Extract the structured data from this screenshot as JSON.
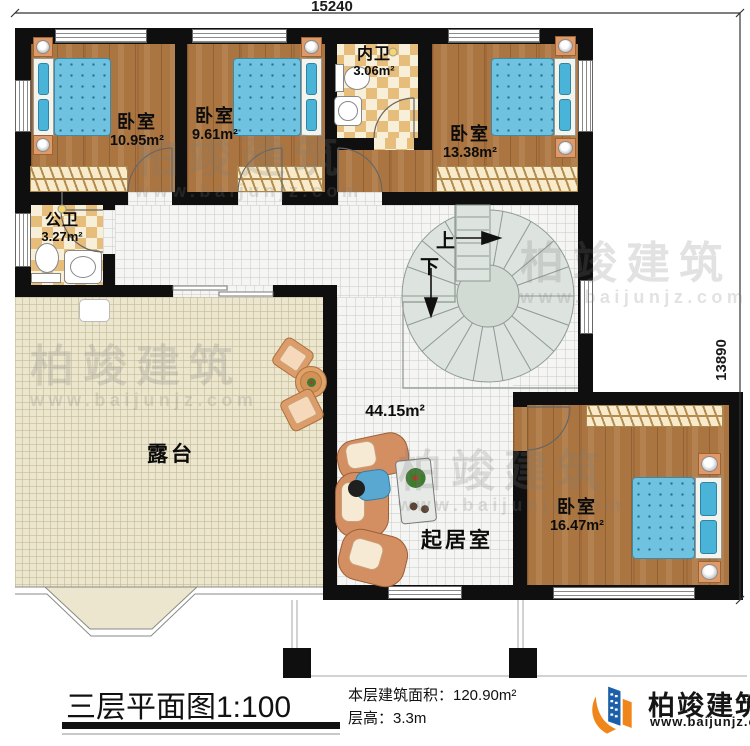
{
  "dimensions": {
    "width": "15240",
    "height": "13890"
  },
  "rooms": {
    "bedroom_tl": {
      "name": "卧室",
      "area": "10.95m²"
    },
    "bedroom_tm": {
      "name": "卧室",
      "area": "9.61m²"
    },
    "bedroom_tr": {
      "name": "卧室",
      "area": "13.38m²"
    },
    "bedroom_br": {
      "name": "卧室",
      "area": "16.47m²"
    },
    "bath_inner": {
      "name": "内卫",
      "area": "3.06m²"
    },
    "bath_public": {
      "name": "公卫",
      "area": "3.27m²"
    },
    "living": {
      "name": "起居室",
      "area": "44.15m²"
    },
    "terrace": {
      "name": "露台"
    },
    "stair_up": "上",
    "stair_down": "下"
  },
  "footer": {
    "title": "三层平面图",
    "scale": "1:100",
    "area_line": "本层建筑面积：120.90m²",
    "height_line": "层高：3.3m"
  },
  "brand": {
    "name": "柏竣建筑",
    "url": "www.baijunjz.com"
  },
  "watermark": {
    "name": "柏竣建筑",
    "url": "www.baijunjz.com"
  }
}
